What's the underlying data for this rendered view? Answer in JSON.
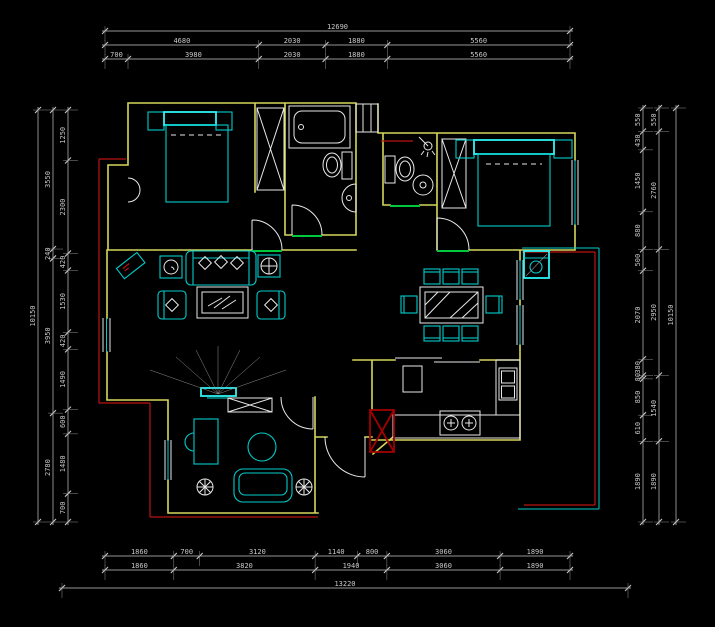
{
  "canvas": {
    "width": 715,
    "height": 627,
    "background": "#000000"
  },
  "colors": {
    "wall": "#d6d65a",
    "furniture": "#00cccc",
    "furniture_bright": "#2ef2f2",
    "fixture": "#e8e8e8",
    "dimension": "#c9c9c9",
    "dimension_faint": "#8f8f8f",
    "exterior_red": "#bb1414",
    "shaft_red": "#a00000",
    "threshold_green": "#00c83c",
    "hatch": "#8f8f8f"
  },
  "dimensions": {
    "top": {
      "row1": [
        "12690"
      ],
      "row2": [
        "4680",
        "2030",
        "1880",
        "5560"
      ],
      "row3": [
        "700",
        "3980",
        "2030",
        "1880",
        "5560"
      ]
    },
    "bottom": {
      "row1": [
        "1860",
        "700",
        "3120",
        "1140",
        "800",
        "3060",
        "1890"
      ],
      "row2": [
        "1860",
        "3820",
        "1940",
        "3060",
        "1890"
      ],
      "row3": [
        "13220"
      ]
    },
    "left": {
      "row1": [
        "10150"
      ],
      "row2": [
        "3550",
        "240",
        "3950",
        "2780"
      ],
      "row3": [
        "1250",
        "2300",
        "420",
        "1530",
        "420",
        "1490",
        "600",
        "1480",
        "700"
      ]
    },
    "right": {
      "row1": [
        "550",
        "430",
        "1450",
        "880",
        "500",
        "2070",
        "380",
        "80",
        "850",
        "610",
        "1890"
      ],
      "row2": [
        "550",
        "2760",
        "2950",
        "1540",
        "1890"
      ],
      "row3": [
        "10150"
      ]
    }
  },
  "features": {
    "drawing_type": "apartment-floor-plan",
    "rooms": [
      "bedroom",
      "bathroom",
      "bathroom",
      "bedroom",
      "living-room",
      "dining-area",
      "kitchen",
      "study",
      "balcony",
      "entry-hall"
    ],
    "furniture_icons": [
      "double-bed-icon",
      "bathtub-icon",
      "toilet-icon",
      "wash-basin-icon",
      "shower-icon",
      "wardrobe-icon",
      "sofa-icon",
      "armchair-icon",
      "coffee-table-icon",
      "side-table-icon",
      "tv-icon",
      "dining-table-icon",
      "dining-chair-icon",
      "refrigerator-icon",
      "kitchen-sink-icon",
      "stove-icon",
      "washing-machine-icon",
      "desk-icon",
      "round-table-icon",
      "loveseat-icon",
      "plant-icon",
      "duct-shaft-icon",
      "door-swing-icon",
      "window-icon"
    ]
  }
}
